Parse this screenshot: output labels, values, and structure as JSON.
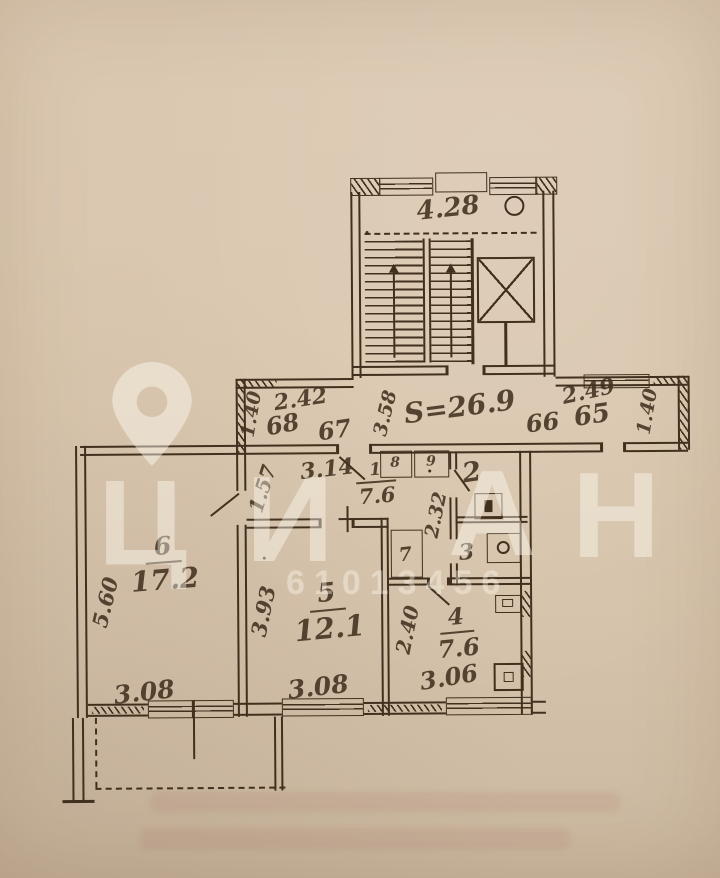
{
  "watermark": {
    "brand_letters": [
      "Ц",
      "И",
      "А",
      "Н"
    ],
    "id_number": "61013456"
  },
  "plan": {
    "stairwell": {
      "top_dim": "4.28"
    },
    "corridor": {
      "area_label": "S=26.9",
      "left_depth_dim": "1.40",
      "left_width_dim": "2.42",
      "stair_side_dim": "3.58",
      "right_width_dim": "2.49",
      "right_depth_dim": "1.40",
      "apartment_numbers": [
        "68",
        "67",
        "66",
        "65"
      ]
    },
    "rooms": {
      "room6": {
        "number": "6",
        "area": "17.2",
        "left_dim": "5.60",
        "bottom_dim": "3.08"
      },
      "room5": {
        "number": "5",
        "area": "12.1",
        "left_dim": "3.93",
        "bottom_dim": "3.08"
      },
      "hall": {
        "number": "1",
        "area": "7.6",
        "top_dim": "3.14",
        "left_dim": "1.57"
      },
      "kitchen": {
        "number": "4",
        "area": "7.6",
        "left_dim": "2.40",
        "bottom_dim": "3.06"
      },
      "wc": {
        "number": "2"
      },
      "bathroom": {
        "number": "3"
      },
      "closet7": {
        "number": "7",
        "side_dim": "2.32"
      },
      "closet8": {
        "number": "8"
      },
      "closet9": {
        "number": "9"
      }
    }
  }
}
